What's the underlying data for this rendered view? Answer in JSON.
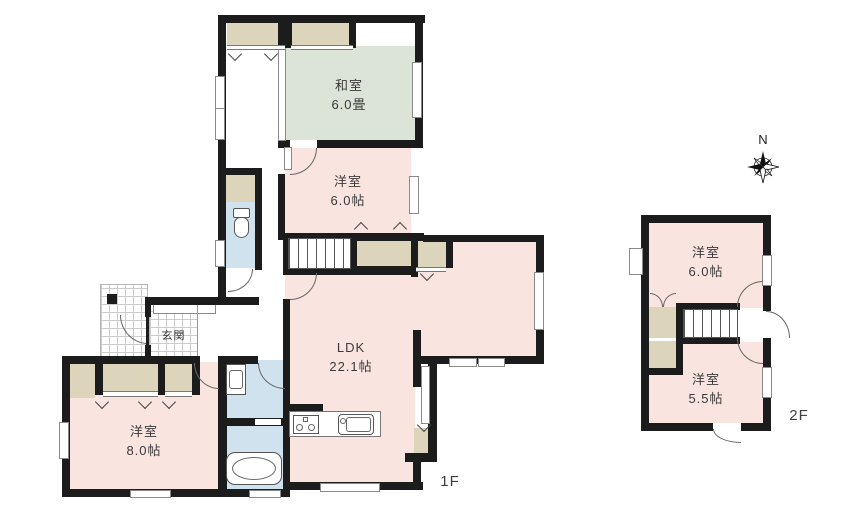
{
  "floor_plan": {
    "floor_labels": {
      "f1": "1F",
      "f2": "2F"
    },
    "compass": {
      "north": "N"
    },
    "rooms": {
      "washitsu": {
        "name": "和室",
        "size": "6.0畳"
      },
      "yoshitsu6_1f": {
        "name": "洋室",
        "size": "6.0帖"
      },
      "ldk": {
        "name": "LDK",
        "size": "22.1帖"
      },
      "genkan": {
        "name": "玄関"
      },
      "yoshitsu8": {
        "name": "洋室",
        "size": "8.0帖"
      },
      "yoshitsu6_2f": {
        "name": "洋室",
        "size": "6.0帖"
      },
      "yoshitsu55": {
        "name": "洋室",
        "size": "5.5帖"
      }
    },
    "colors": {
      "wall": "#1c1c1c",
      "western_room": "#f9e4df",
      "tatami_room": "#dbe4d7",
      "closet": "#ddd5bb",
      "wet_area": "#cfe2ed"
    }
  }
}
